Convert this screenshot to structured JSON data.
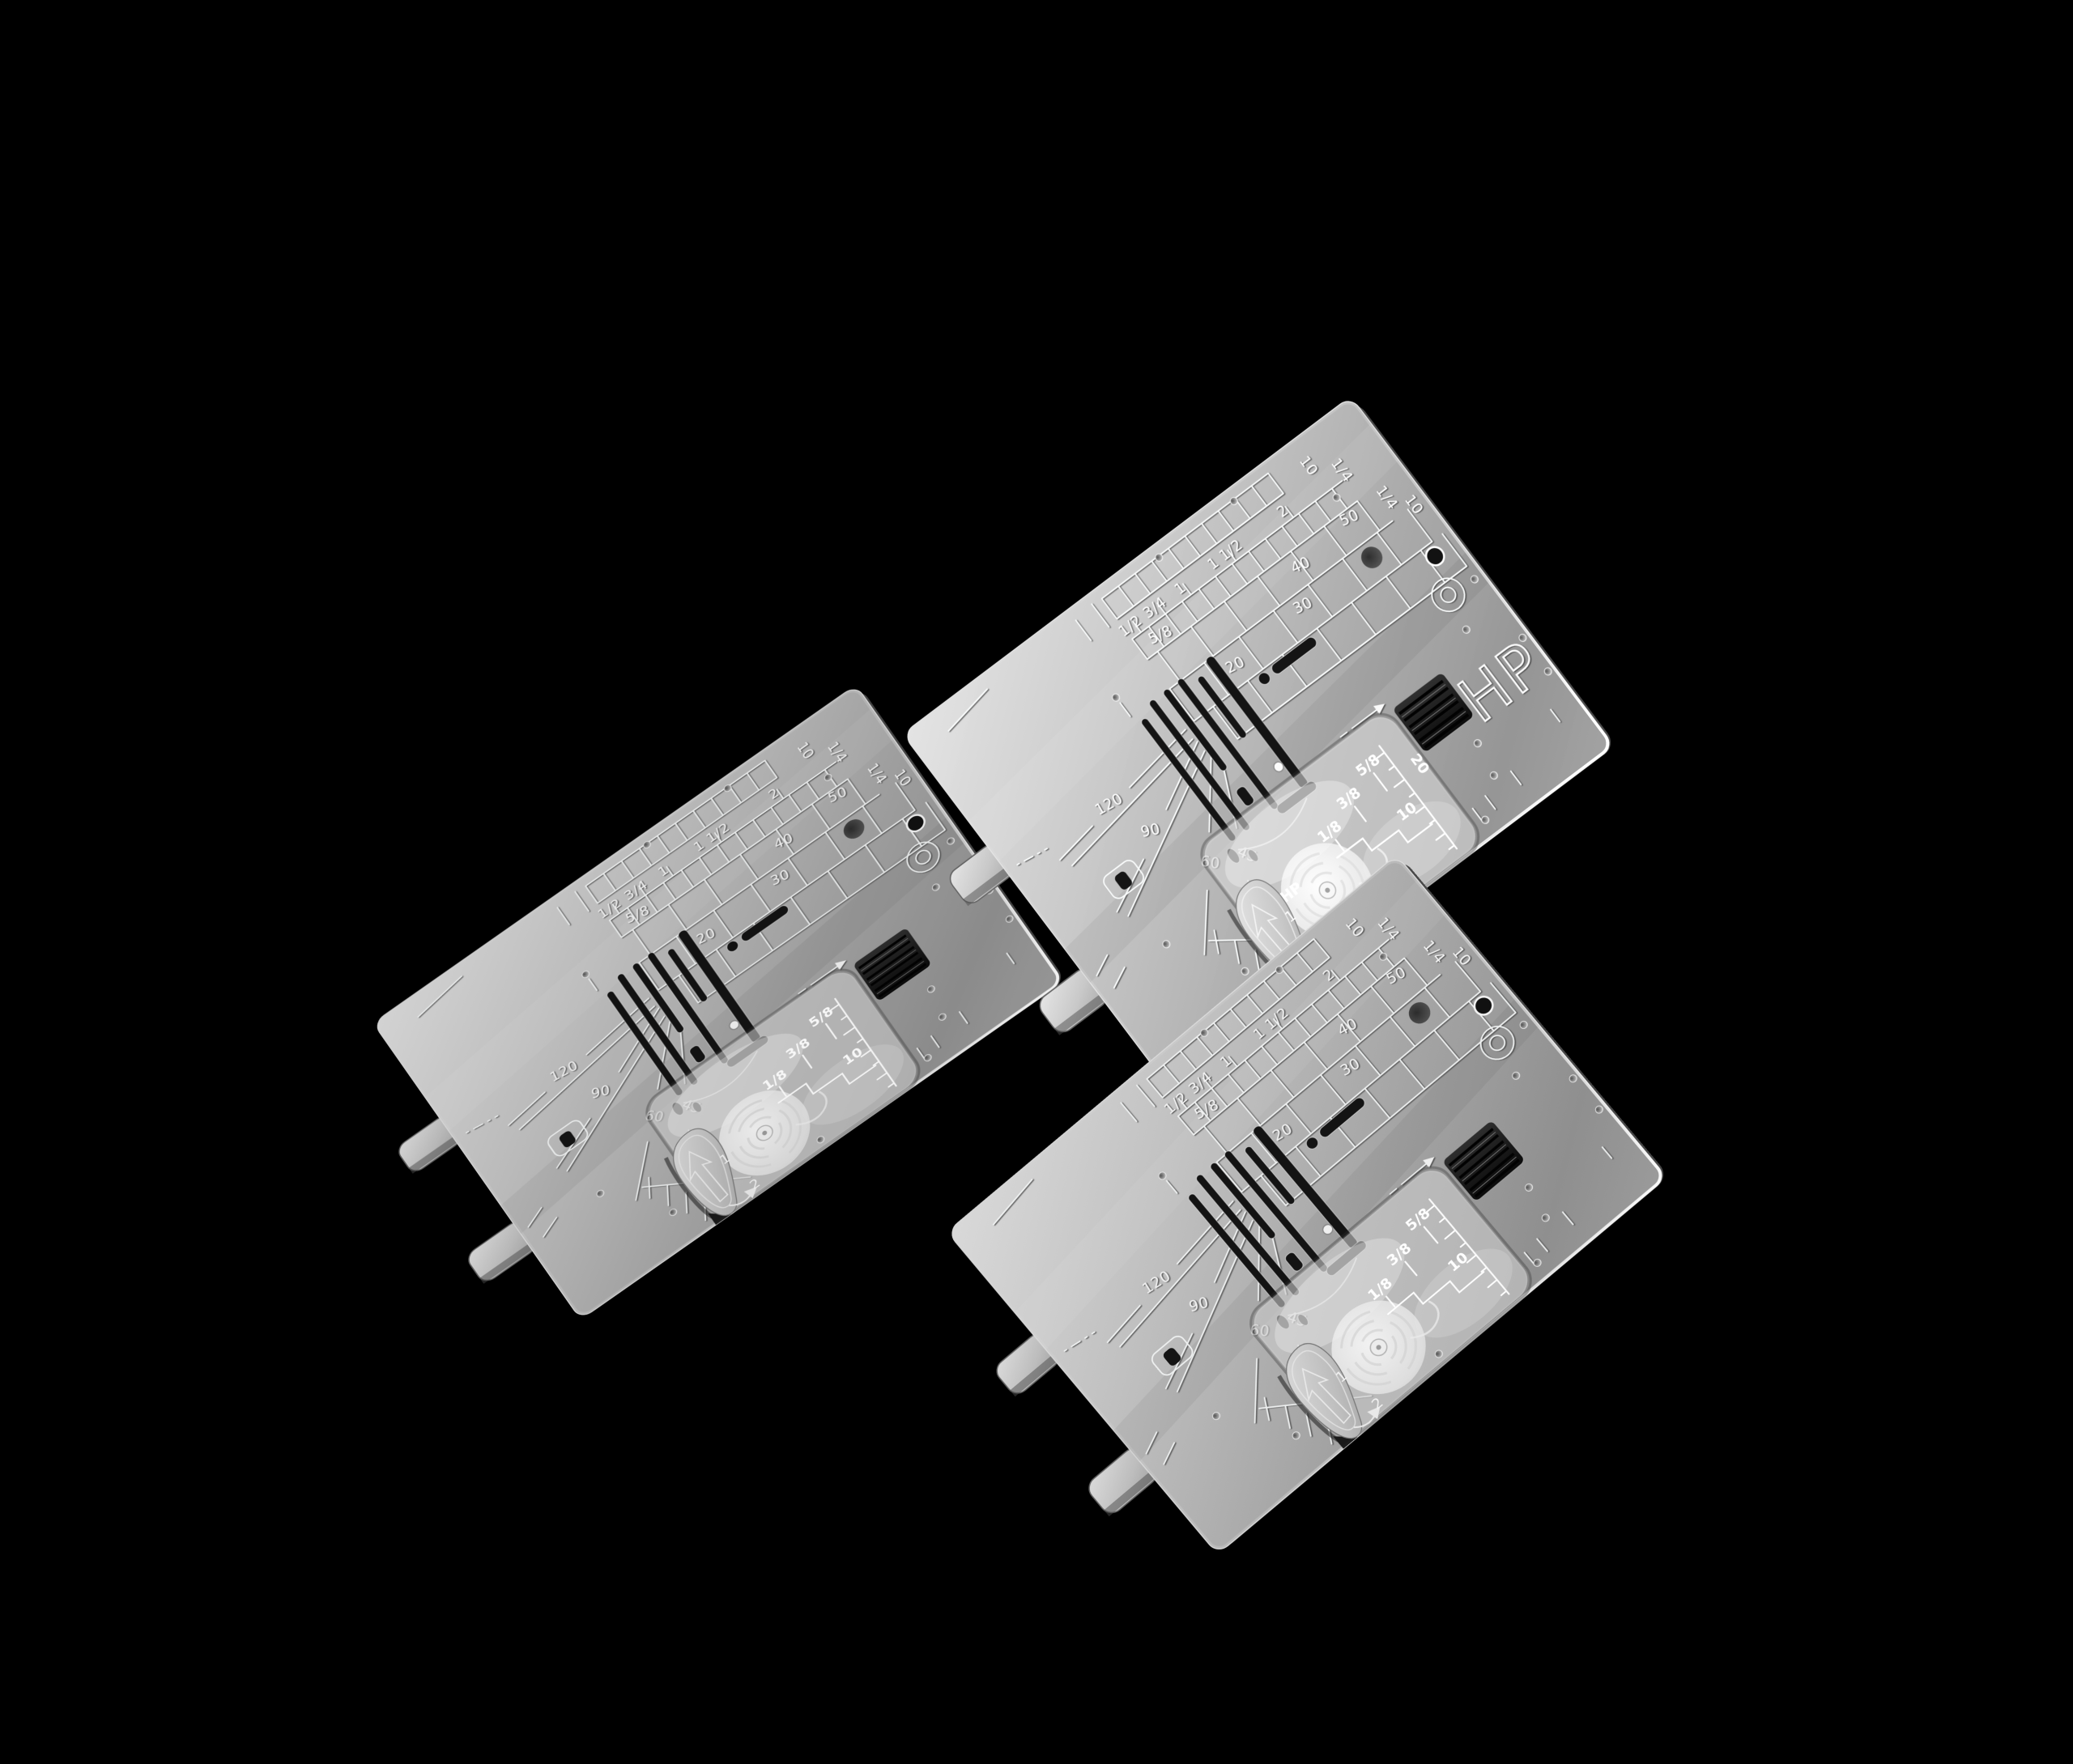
{
  "colors": {
    "background": "#000000",
    "plate_metal": "#b5b5b5",
    "engraving": "#f2f2f2",
    "slot_dark": "#131313",
    "cover_tint": "#f5f5f5",
    "grating_dark": "#1a1a1a",
    "button_gray": "#c4c4c4"
  },
  "plates": [
    {
      "id": "needle-plate-left",
      "grid": {
        "f12": "1/2",
        "f34": "3/4",
        "f1": "1",
        "f112": "1 1/2",
        "f2": "2",
        "r10a": "10",
        "r14a": "1/4",
        "m58": "5/8",
        "m40": "40",
        "m50": "50",
        "r14b": "1/4",
        "r10b": "10",
        "m20": "20",
        "m30": "30"
      },
      "angles": {
        "a120": "120",
        "a90": "90",
        "a60": "60",
        "a45": "45"
      },
      "cover": {
        "c18": "1/8",
        "c38": "3/8",
        "c58": "5/8",
        "c10": "10",
        "c20": "",
        "hp": ""
      },
      "latch": {
        "l1": "1",
        "l2": "2"
      },
      "hp": ""
    },
    {
      "id": "needle-plate-hp-top-right",
      "grid": {
        "f12": "1/2",
        "f34": "3/4",
        "f1": "1",
        "f112": "1 1/2",
        "f2": "2",
        "r10a": "10",
        "r14a": "1/4",
        "m58": "5/8",
        "m40": "40",
        "m50": "50",
        "r14b": "1/4",
        "r10b": "10",
        "m20": "20",
        "m30": "30"
      },
      "angles": {
        "a120": "120",
        "a90": "90",
        "a60": "60",
        "a45": "45"
      },
      "cover": {
        "c18": "1/8",
        "c38": "3/8",
        "c58": "5/8",
        "c10": "10",
        "c20": "20",
        "hp": "HP"
      },
      "latch": {
        "l1": "1",
        "l2": "2"
      },
      "hp": "HP"
    },
    {
      "id": "needle-plate-bottom-right",
      "grid": {
        "f12": "1/2",
        "f34": "3/4",
        "f1": "1",
        "f112": "1 1/2",
        "f2": "2",
        "r10a": "10",
        "r14a": "1/4",
        "m58": "5/8",
        "m40": "40",
        "m50": "50",
        "r14b": "1/4",
        "r10b": "10",
        "m20": "20",
        "m30": "30"
      },
      "angles": {
        "a120": "120",
        "a90": "90",
        "a60": "60",
        "a45": "45"
      },
      "cover": {
        "c18": "1/8",
        "c38": "3/8",
        "c58": "5/8",
        "c10": "10",
        "c20": "",
        "hp": ""
      },
      "latch": {
        "l1": "1",
        "l2": "2"
      },
      "hp": ""
    }
  ]
}
